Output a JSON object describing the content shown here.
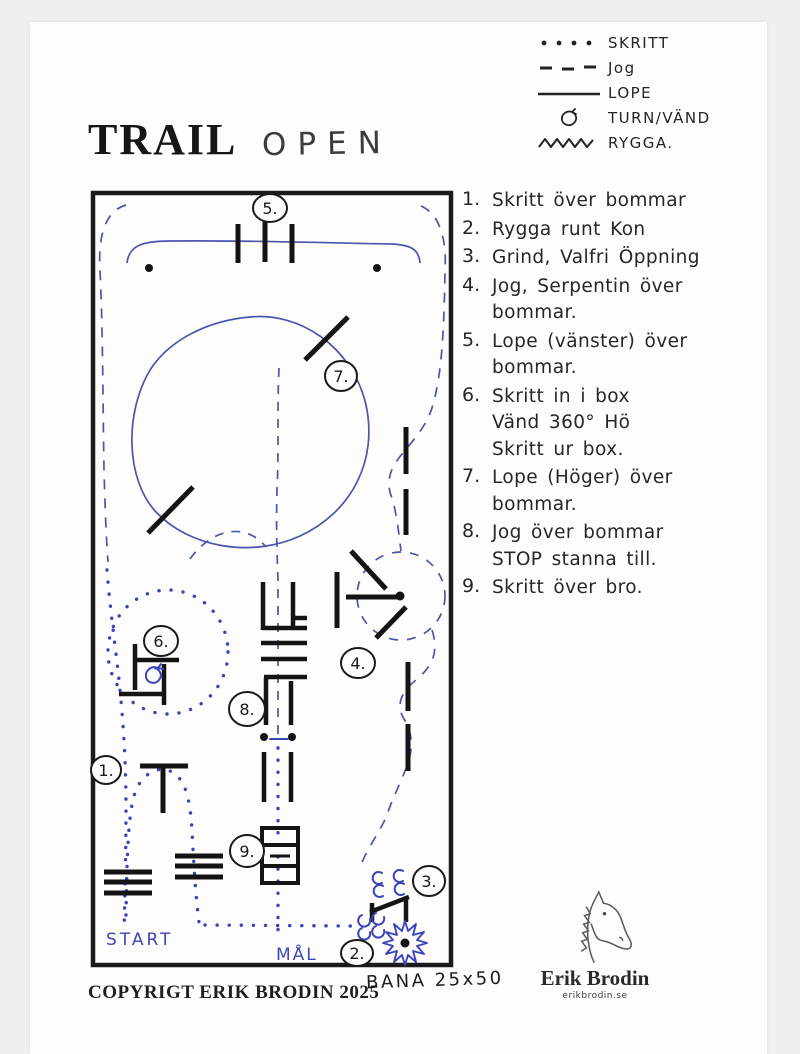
{
  "page": {
    "title": "TRAIL",
    "subtitle": "OPEN",
    "copyright": "COPYRIGT ERIK BRODIN 2025",
    "arena_size": "BANA 25x50"
  },
  "legend": {
    "items": [
      {
        "icon": "dotted-line-icon",
        "label": "SKRITT"
      },
      {
        "icon": "dashed-line-icon",
        "label": "Jog"
      },
      {
        "icon": "solid-line-icon",
        "label": "LOPE"
      },
      {
        "icon": "turn-icon",
        "label": "TURN/VÄND"
      },
      {
        "icon": "zigzag-line-icon",
        "label": "RYGGA."
      }
    ]
  },
  "instructions": [
    {
      "num": "1.",
      "text": "Skritt över bommar"
    },
    {
      "num": "2.",
      "text": "Rygga runt Kon"
    },
    {
      "num": "3.",
      "text": "Grind, Valfri Öppning"
    },
    {
      "num": "4.",
      "text": "Jog, Serpentin över\nbommar."
    },
    {
      "num": "5.",
      "text": "Lope (vänster) över\nbommar."
    },
    {
      "num": "6.",
      "text": "Skritt in i box\nVänd 360° Hö\nSkritt ur box."
    },
    {
      "num": "7.",
      "text": "Lope (Höger) över\nbommar."
    },
    {
      "num": "8.",
      "text": "Jog över bommar\nSTOP stanna till."
    },
    {
      "num": "9.",
      "text": "Skritt över bro."
    }
  ],
  "map": {
    "start_label": "START",
    "goal_label": "MÅL",
    "labels": {
      "n1": "1.",
      "n2": "2.",
      "n3": "3.",
      "n4": "4.",
      "n5": "5.",
      "n6": "6.",
      "n7": "7.",
      "n8": "8.",
      "n9": "9."
    }
  },
  "logo": {
    "name": "Erik Brodin",
    "site": "erikbrodin.se"
  },
  "colors": {
    "ink": "#1c1c1c",
    "path_blue": "#4a55ae",
    "mark_blue": "#3b44bb",
    "paper": "#fdfdfc",
    "background": "#eff0f2"
  }
}
